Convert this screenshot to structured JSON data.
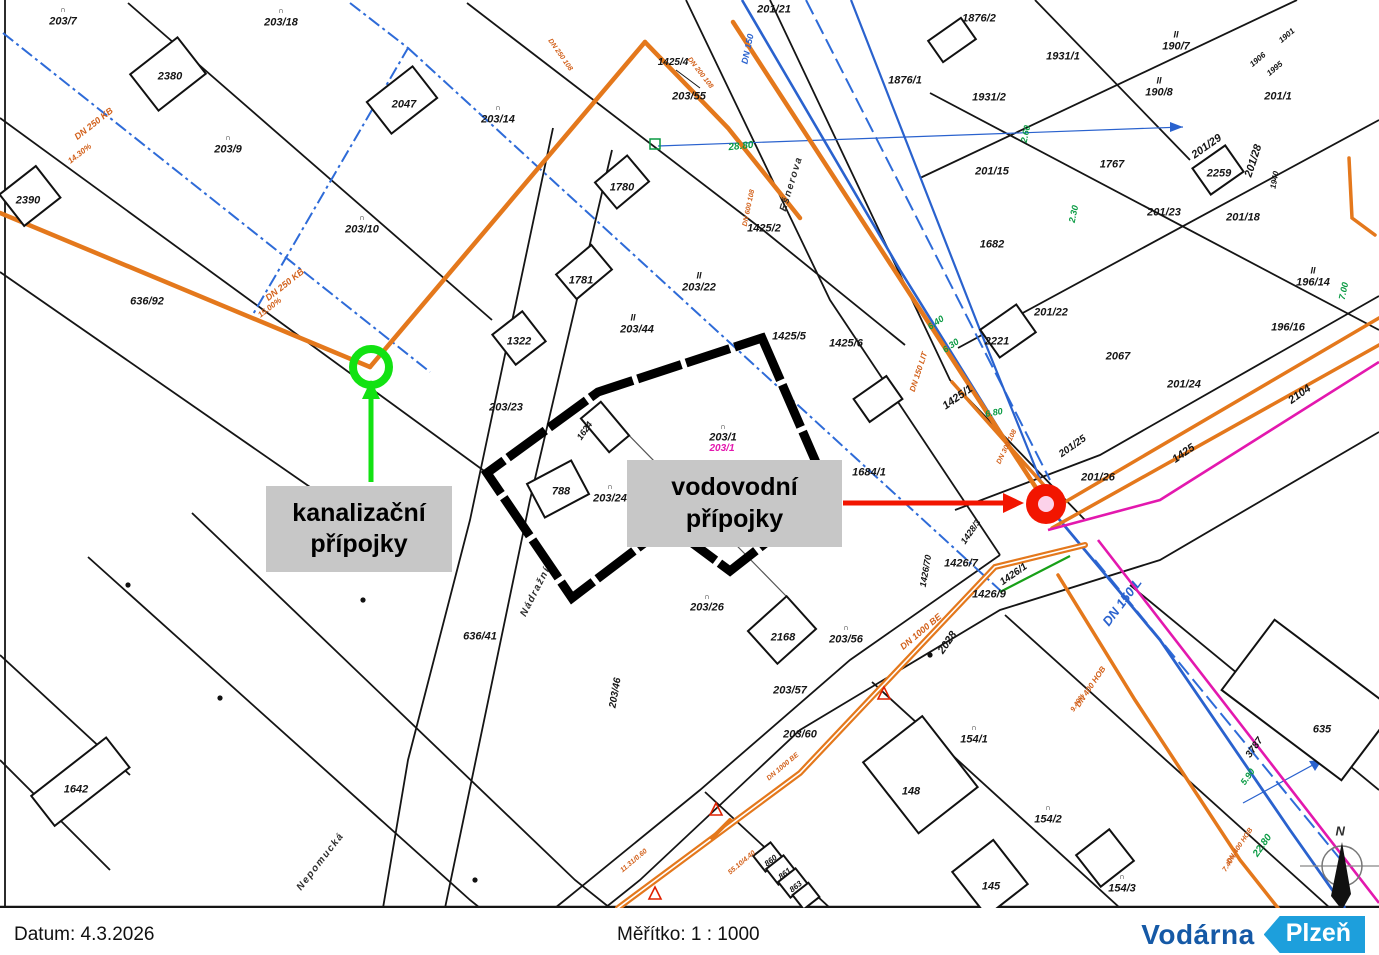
{
  "footer": {
    "date_label": "Datum: 4.3.2026",
    "scale_label": "Měřítko: 1 : 1000"
  },
  "logo": {
    "name": "Vodárna",
    "city": "Plzeň"
  },
  "callouts": {
    "sewer_line1": "kanalizační",
    "sewer_line2": "přípojky",
    "water_line1": "vodovodní",
    "water_line2": "přípojky"
  },
  "colors": {
    "sewer_orange": "#e4781c",
    "water_blue": "#2a62ce",
    "boundary_blue_dashdot": "#2e6bd8",
    "magenta_line": "#e318ae",
    "green_marker": "#12e212",
    "red_marker": "#f21500",
    "callout_gray": "#c7c7c7",
    "logo_navy": "#1559a6",
    "logo_lightblue": "#1d9fdc"
  },
  "map": {
    "labels": [
      {
        "t": "∩",
        "x": 63,
        "y": 10,
        "s": 8
      },
      {
        "t": "203/7",
        "x": 63,
        "y": 22
      },
      {
        "t": "∩",
        "x": 281,
        "y": 11,
        "s": 8
      },
      {
        "t": "203/18",
        "x": 281,
        "y": 23
      },
      {
        "t": "2380",
        "x": 170,
        "y": 77
      },
      {
        "t": "2047",
        "x": 404,
        "y": 105
      },
      {
        "t": "∩",
        "x": 228,
        "y": 138,
        "s": 8
      },
      {
        "t": "203/9",
        "x": 228,
        "y": 150
      },
      {
        "t": "∩",
        "x": 498,
        "y": 108,
        "s": 8
      },
      {
        "t": "203/14",
        "x": 498,
        "y": 120
      },
      {
        "t": "2390",
        "x": 28,
        "y": 201
      },
      {
        "t": "∩",
        "x": 362,
        "y": 218,
        "s": 8
      },
      {
        "t": "203/10",
        "x": 362,
        "y": 230
      },
      {
        "t": "636/92",
        "x": 147,
        "y": 302
      },
      {
        "t": "201/21",
        "x": 774,
        "y": 10
      },
      {
        "t": "1425/4",
        "x": 673,
        "y": 63,
        "s": 10
      },
      {
        "t": "203/55",
        "x": 689,
        "y": 97
      },
      {
        "t": "1780",
        "x": 622,
        "y": 188
      },
      {
        "t": "1781",
        "x": 581,
        "y": 281
      },
      {
        "t": "II",
        "x": 699,
        "y": 276,
        "s": 9
      },
      {
        "t": "203/22",
        "x": 699,
        "y": 288
      },
      {
        "t": "II",
        "x": 633,
        "y": 318,
        "s": 9
      },
      {
        "t": "203/44",
        "x": 637,
        "y": 330
      },
      {
        "t": "1322",
        "x": 519,
        "y": 342
      },
      {
        "t": "203/23",
        "x": 506,
        "y": 408
      },
      {
        "t": "1624",
        "x": 585,
        "y": 431,
        "r": -55,
        "s": 9
      },
      {
        "t": "∩",
        "x": 723,
        "y": 427,
        "s": 8
      },
      {
        "t": "203/1",
        "x": 723,
        "y": 438
      },
      {
        "t": "203/1",
        "x": 722,
        "y": 449,
        "c": "m",
        "s": 10
      },
      {
        "t": "788",
        "x": 561,
        "y": 492
      },
      {
        "t": "∩",
        "x": 610,
        "y": 487,
        "s": 8
      },
      {
        "t": "203/24",
        "x": 610,
        "y": 499
      },
      {
        "t": "1425/5",
        "x": 789,
        "y": 337
      },
      {
        "t": "1425/6",
        "x": 846,
        "y": 344
      },
      {
        "t": "1425/2",
        "x": 764,
        "y": 229
      },
      {
        "t": "1684/1",
        "x": 869,
        "y": 473
      },
      {
        "t": "2221",
        "x": 997,
        "y": 342
      },
      {
        "t": "201/22",
        "x": 1051,
        "y": 313
      },
      {
        "t": "1425/1",
        "x": 958,
        "y": 398,
        "r": -35
      },
      {
        "t": "1931/1",
        "x": 1063,
        "y": 57
      },
      {
        "t": "1931/2",
        "x": 989,
        "y": 98
      },
      {
        "t": "1876/2",
        "x": 979,
        "y": 19
      },
      {
        "t": "1876/1",
        "x": 905,
        "y": 81
      },
      {
        "t": "II",
        "x": 1176,
        "y": 35,
        "s": 9
      },
      {
        "t": "190/7",
        "x": 1176,
        "y": 47
      },
      {
        "t": "II",
        "x": 1159,
        "y": 81,
        "s": 9
      },
      {
        "t": "190/8",
        "x": 1159,
        "y": 93
      },
      {
        "t": "201/1",
        "x": 1278,
        "y": 97
      },
      {
        "t": "201/15",
        "x": 992,
        "y": 172
      },
      {
        "t": "1767",
        "x": 1112,
        "y": 165
      },
      {
        "t": "201/29",
        "x": 1207,
        "y": 147,
        "r": -35
      },
      {
        "t": "2259",
        "x": 1219,
        "y": 174
      },
      {
        "t": "201/28",
        "x": 1254,
        "y": 161,
        "r": -72
      },
      {
        "t": "1940",
        "x": 1275,
        "y": 180,
        "r": -80,
        "s": 8
      },
      {
        "t": "1901",
        "x": 1287,
        "y": 36,
        "r": -40,
        "s": 8
      },
      {
        "t": "1906",
        "x": 1258,
        "y": 60,
        "r": -40,
        "s": 8
      },
      {
        "t": "1995",
        "x": 1275,
        "y": 69,
        "r": -40,
        "s": 8
      },
      {
        "t": "201/18",
        "x": 1243,
        "y": 218
      },
      {
        "t": "1682",
        "x": 992,
        "y": 245
      },
      {
        "t": "201/23",
        "x": 1164,
        "y": 213
      },
      {
        "t": "II",
        "x": 1313,
        "y": 271,
        "s": 9
      },
      {
        "t": "196/14",
        "x": 1313,
        "y": 283
      },
      {
        "t": "196/16",
        "x": 1288,
        "y": 328
      },
      {
        "t": "2067",
        "x": 1118,
        "y": 357
      },
      {
        "t": "201/24",
        "x": 1184,
        "y": 385
      },
      {
        "t": "1425",
        "x": 1184,
        "y": 454,
        "r": -35
      },
      {
        "t": "2104",
        "x": 1300,
        "y": 395,
        "r": -35
      },
      {
        "t": "201/26",
        "x": 1098,
        "y": 478
      },
      {
        "t": "201/25",
        "x": 1073,
        "y": 447,
        "r": -35,
        "s": 10
      },
      {
        "t": "1426/70",
        "x": 926,
        "y": 571,
        "r": -80,
        "s": 9
      },
      {
        "t": "1428/3",
        "x": 971,
        "y": 532,
        "r": -55,
        "s": 9
      },
      {
        "t": "1426/7",
        "x": 961,
        "y": 564
      },
      {
        "t": "1426/9",
        "x": 989,
        "y": 595
      },
      {
        "t": "1426/1",
        "x": 1014,
        "y": 575,
        "r": -35,
        "s": 10
      },
      {
        "t": "2028",
        "x": 948,
        "y": 643,
        "r": -55
      },
      {
        "t": "∩",
        "x": 707,
        "y": 597,
        "s": 8
      },
      {
        "t": "203/26",
        "x": 707,
        "y": 608
      },
      {
        "t": "2168",
        "x": 783,
        "y": 638
      },
      {
        "t": "∩",
        "x": 846,
        "y": 628,
        "s": 8
      },
      {
        "t": "203/56",
        "x": 846,
        "y": 640
      },
      {
        "t": "203/57",
        "x": 790,
        "y": 691
      },
      {
        "t": "203/60",
        "x": 800,
        "y": 735
      },
      {
        "t": "203/46",
        "x": 616,
        "y": 693,
        "r": -80,
        "s": 10
      },
      {
        "t": "∩",
        "x": 974,
        "y": 728,
        "s": 8
      },
      {
        "t": "154/1",
        "x": 974,
        "y": 740
      },
      {
        "t": "148",
        "x": 911,
        "y": 792
      },
      {
        "t": "145",
        "x": 991,
        "y": 887
      },
      {
        "t": "860",
        "x": 771,
        "y": 861,
        "r": -38,
        "s": 8
      },
      {
        "t": "861",
        "x": 785,
        "y": 874,
        "r": -38,
        "s": 8
      },
      {
        "t": "863",
        "x": 796,
        "y": 887,
        "r": -38,
        "s": 8
      },
      {
        "t": "∩",
        "x": 1048,
        "y": 808,
        "s": 8
      },
      {
        "t": "154/2",
        "x": 1048,
        "y": 820
      },
      {
        "t": "∩",
        "x": 1122,
        "y": 877,
        "s": 8
      },
      {
        "t": "154/3",
        "x": 1122,
        "y": 889
      },
      {
        "t": "635",
        "x": 1322,
        "y": 730
      },
      {
        "t": "1642",
        "x": 76,
        "y": 790
      },
      {
        "t": "636/41",
        "x": 480,
        "y": 637
      },
      {
        "t": "3787",
        "x": 1255,
        "y": 748,
        "r": -55,
        "s": 10
      },
      {
        "t": "Nádražní",
        "x": 536,
        "y": 592,
        "r": -63,
        "c": "n",
        "s": 10
      },
      {
        "t": "Nepomucká",
        "x": 321,
        "y": 862,
        "r": -52,
        "c": "n",
        "s": 10
      },
      {
        "t": "Ešnerova",
        "x": 792,
        "y": 184,
        "r": -73,
        "c": "n",
        "s": 10
      },
      {
        "t": "DN 250 KB",
        "x": 94,
        "y": 124,
        "r": -38,
        "c": "o",
        "s": 9
      },
      {
        "t": "14.30%",
        "x": 80,
        "y": 154,
        "r": -38,
        "c": "o",
        "s": 8
      },
      {
        "t": "DN 250 KB",
        "x": 285,
        "y": 285,
        "r": -38,
        "c": "o",
        "s": 9
      },
      {
        "t": "15.00%",
        "x": 270,
        "y": 308,
        "r": -38,
        "c": "o",
        "s": 8
      },
      {
        "t": "DN 250 108",
        "x": 560,
        "y": 55,
        "r": 55,
        "c": "o",
        "s": 7
      },
      {
        "t": "DN 200 108",
        "x": 700,
        "y": 73,
        "r": 52,
        "c": "o",
        "s": 7
      },
      {
        "t": "DN 600 108",
        "x": 749,
        "y": 208,
        "r": -78,
        "c": "o",
        "s": 7
      },
      {
        "t": "DN 150 LIT",
        "x": 919,
        "y": 372,
        "r": -72,
        "c": "o",
        "s": 8
      },
      {
        "t": "DN 300 108",
        "x": 1007,
        "y": 447,
        "r": -64,
        "c": "o",
        "s": 7
      },
      {
        "t": "DN 1000 BE",
        "x": 921,
        "y": 632,
        "r": -40,
        "c": "o",
        "s": 9
      },
      {
        "t": "DN 1000 BE",
        "x": 783,
        "y": 767,
        "r": -40,
        "c": "o",
        "s": 7
      },
      {
        "t": "DN 400 HOB",
        "x": 1091,
        "y": 687,
        "r": -56,
        "c": "o",
        "s": 8
      },
      {
        "t": "9.40%",
        "x": 1078,
        "y": 703,
        "r": -56,
        "c": "o",
        "s": 7
      },
      {
        "t": "DN 400 HOB",
        "x": 1240,
        "y": 846,
        "r": -56,
        "c": "o",
        "s": 7
      },
      {
        "t": "7.40%",
        "x": 1230,
        "y": 863,
        "r": -56,
        "c": "o",
        "s": 7
      },
      {
        "t": "55.10/4.40",
        "x": 742,
        "y": 863,
        "r": -40,
        "c": "o",
        "s": 7
      },
      {
        "t": "11.31/0.60",
        "x": 634,
        "y": 861,
        "r": -40,
        "c": "o",
        "s": 7
      },
      {
        "t": "DN 150",
        "x": 748,
        "y": 49,
        "r": -78,
        "c": "b",
        "s": 9
      },
      {
        "t": "DN 150 L",
        "x": 1122,
        "y": 602,
        "r": -53,
        "c": "b",
        "s": 13
      },
      {
        "t": "28.80",
        "x": 741,
        "y": 147,
        "r": -6,
        "c": "g",
        "s": 10
      },
      {
        "t": "6.40",
        "x": 936,
        "y": 323,
        "r": -35,
        "c": "g",
        "s": 9
      },
      {
        "t": "6.30",
        "x": 951,
        "y": 346,
        "r": -35,
        "c": "g",
        "s": 9
      },
      {
        "t": "6.80",
        "x": 994,
        "y": 413,
        "r": -10,
        "c": "g",
        "s": 9
      },
      {
        "t": "2.60",
        "x": 1026,
        "y": 134,
        "r": -78,
        "c": "g",
        "s": 9
      },
      {
        "t": "2.30",
        "x": 1074,
        "y": 214,
        "r": -78,
        "c": "g",
        "s": 9
      },
      {
        "t": "5.90",
        "x": 1248,
        "y": 777,
        "r": -55,
        "c": "g",
        "s": 9
      },
      {
        "t": "22.80",
        "x": 1263,
        "y": 846,
        "r": -55,
        "c": "g",
        "s": 10
      },
      {
        "t": "7.00",
        "x": 1344,
        "y": 291,
        "r": -78,
        "c": "g",
        "s": 9
      },
      {
        "t": "N",
        "x": 1341,
        "y": 831,
        "c": "n",
        "s": 13
      }
    ]
  }
}
